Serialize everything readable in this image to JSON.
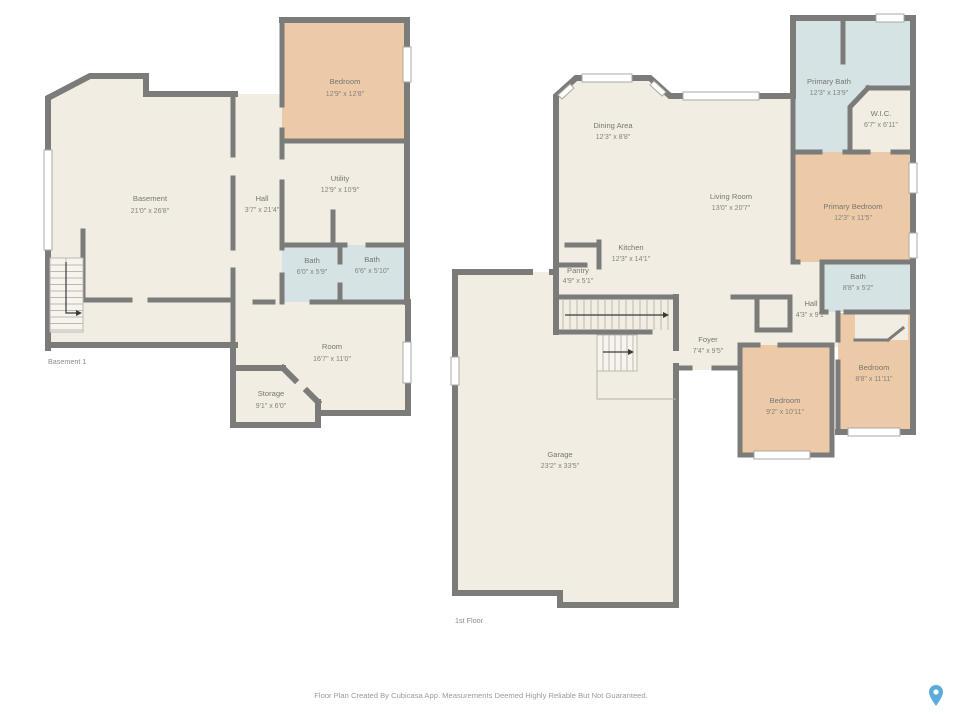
{
  "page": {
    "footer": "Floor Plan Created By Cubicasa App. Measurements Deemed Highly Reliable But Not Guaranteed."
  },
  "colors": {
    "wall": "#7b7b79",
    "floor": "#f2ede3",
    "bedroom": "#eccaa8",
    "bath": "#d5e3e4",
    "label_text": "#787672",
    "muted_text": "#9b9b99",
    "pin": "#5aabdc"
  },
  "icons": {
    "location_pin": "location-pin-icon"
  },
  "floors": [
    {
      "label": "Basement 1",
      "rooms": [
        {
          "name": "Basement",
          "dims": "21'0\" x 26'8\""
        },
        {
          "name": "Hall",
          "dims": "3'7\" x 21'4\""
        },
        {
          "name": "Bedroom",
          "dims": "12'9\" x 12'8\""
        },
        {
          "name": "Utility",
          "dims": "12'9\" x 10'9\""
        },
        {
          "name": "Bath",
          "dims": "6'0\" x 5'9\""
        },
        {
          "name": "Bath",
          "dims": "6'6\" x 5'10\""
        },
        {
          "name": "Room",
          "dims": "16'7\" x 11'0\""
        },
        {
          "name": "Storage",
          "dims": "9'1\" x 6'0\""
        }
      ]
    },
    {
      "label": "1st Floor",
      "rooms": [
        {
          "name": "Dining Area",
          "dims": "12'3\" x 8'8\""
        },
        {
          "name": "Living Room",
          "dims": "13'0\" x 20'7\""
        },
        {
          "name": "Primary Bath",
          "dims": "12'3\" x 13'9\""
        },
        {
          "name": "W.I.C.",
          "dims": "6'7\" x 6'11\""
        },
        {
          "name": "Primary Bedroom",
          "dims": "12'3\" x 11'5\""
        },
        {
          "name": "Kitchen",
          "dims": "12'3\" x 14'1\""
        },
        {
          "name": "Pantry",
          "dims": "4'9\" x 5'1\""
        },
        {
          "name": "Bath",
          "dims": "8'8\" x 5'2\""
        },
        {
          "name": "Hall",
          "dims": "4'3\" x 9'1\""
        },
        {
          "name": "Foyer",
          "dims": "7'4\" x 9'5\""
        },
        {
          "name": "Bedroom",
          "dims": "9'2\" x 10'11\""
        },
        {
          "name": "Bedroom",
          "dims": "8'8\" x 11'11\""
        },
        {
          "name": "Garage",
          "dims": "23'2\" x 33'5\""
        }
      ]
    }
  ]
}
